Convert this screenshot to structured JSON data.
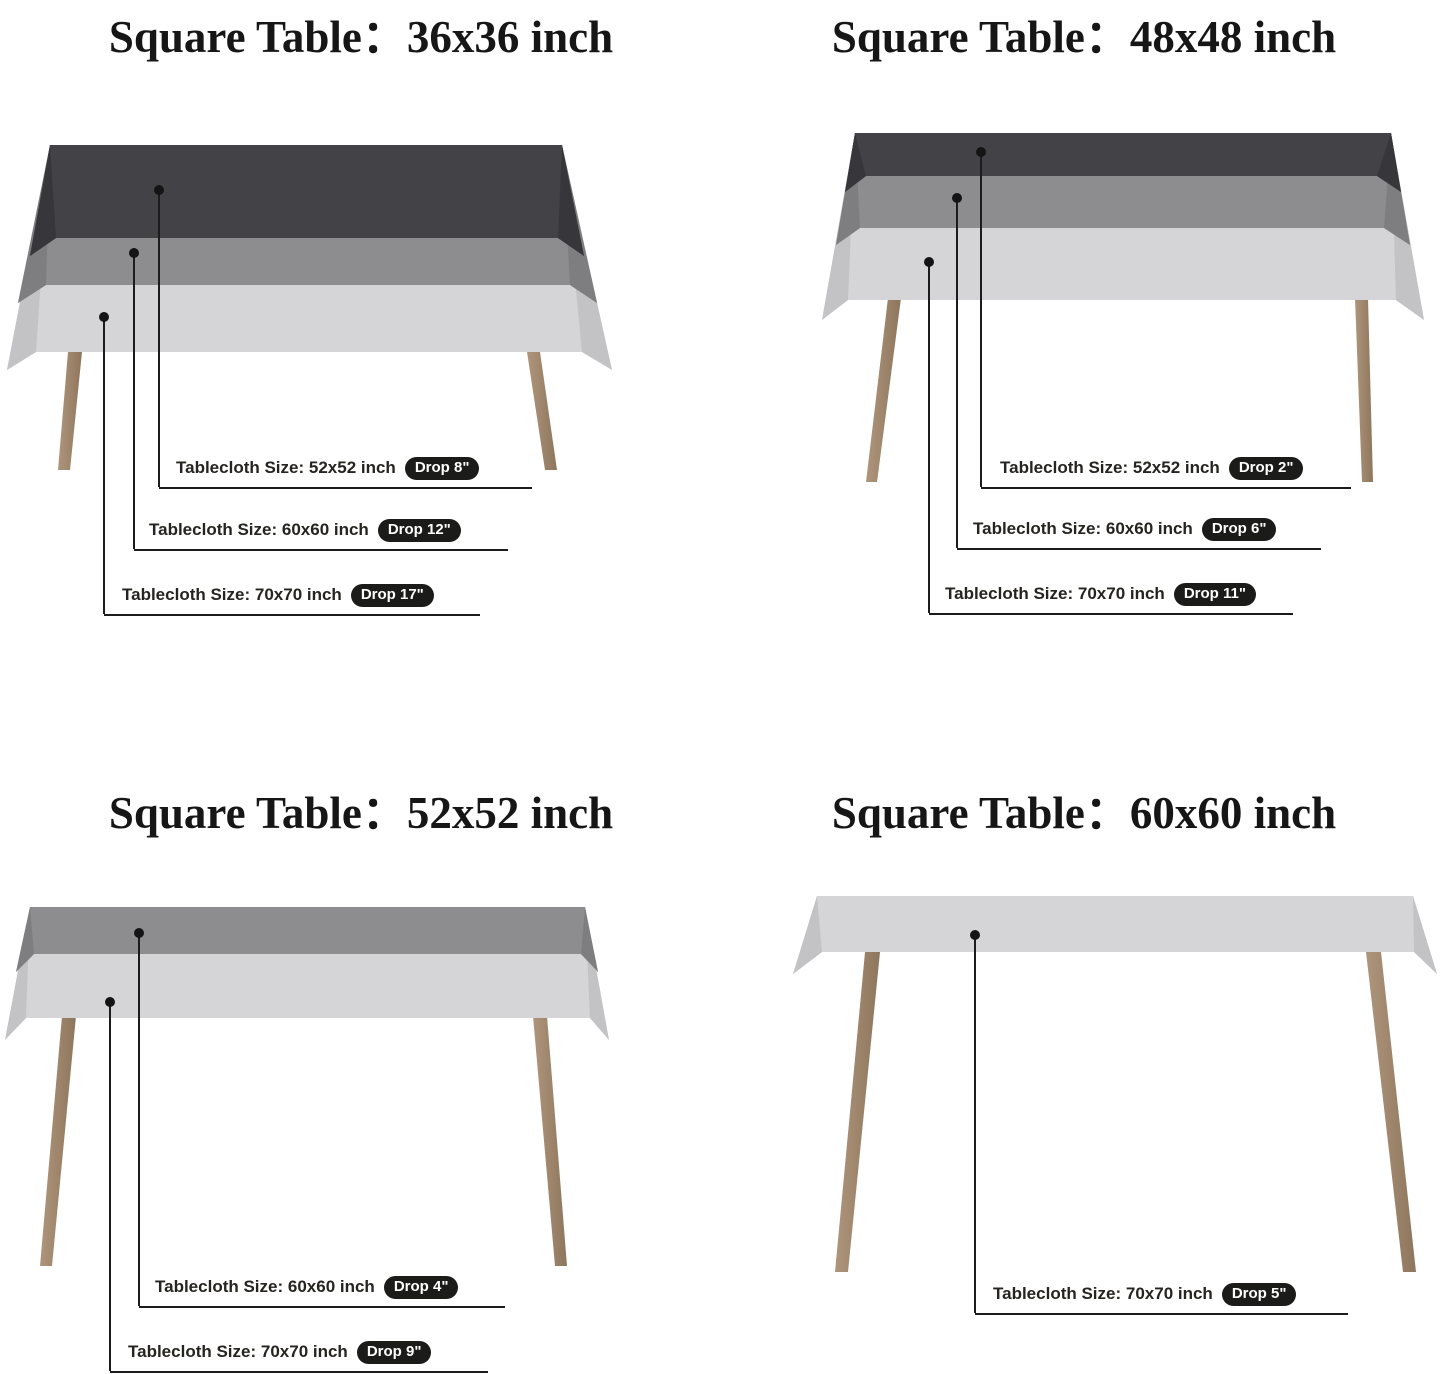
{
  "doc": {
    "type": "tablecloth-size-guide",
    "background": "#ffffff"
  },
  "colors": {
    "cloth_dark": "#434347",
    "cloth_dark_fold": "#37373b",
    "cloth_medium": "#8d8d90",
    "cloth_medium_fold": "#7e7e81",
    "cloth_light": "#d5d5d7",
    "cloth_light_fold": "#c3c3c6",
    "leg_light": "#ae957b",
    "leg_dark": "#8e765d",
    "line": "#1c1c1c",
    "pill_bg": "#1b1b19",
    "pill_text": "#ffffff",
    "title_text": "#161616",
    "label_text": "#262420"
  },
  "panels": [
    {
      "title": "Square Table：36x36 inch",
      "table_size": "36x36 inch",
      "callouts": [
        {
          "label": "Tablecloth Size: 52x52 inch",
          "drop": "Drop 8\""
        },
        {
          "label": "Tablecloth Size: 60x60 inch",
          "drop": "Drop 12\""
        },
        {
          "label": "Tablecloth Size: 70x70 inch",
          "drop": "Drop 17\""
        }
      ]
    },
    {
      "title": "Square Table：48x48 inch",
      "table_size": "48x48 inch",
      "callouts": [
        {
          "label": "Tablecloth Size: 52x52 inch",
          "drop": "Drop 2\""
        },
        {
          "label": "Tablecloth Size: 60x60 inch",
          "drop": "Drop 6\""
        },
        {
          "label": "Tablecloth Size: 70x70 inch",
          "drop": "Drop 11\""
        }
      ]
    },
    {
      "title": "Square Table：52x52 inch",
      "table_size": "52x52 inch",
      "callouts": [
        {
          "label": "Tablecloth Size: 60x60 inch",
          "drop": "Drop 4\""
        },
        {
          "label": "Tablecloth Size: 70x70 inch",
          "drop": "Drop 9\""
        }
      ]
    },
    {
      "title": "Square Table：60x60 inch",
      "table_size": "60x60 inch",
      "callouts": [
        {
          "label": "Tablecloth Size: 70x70 inch",
          "drop": "Drop 5\""
        }
      ]
    }
  ]
}
